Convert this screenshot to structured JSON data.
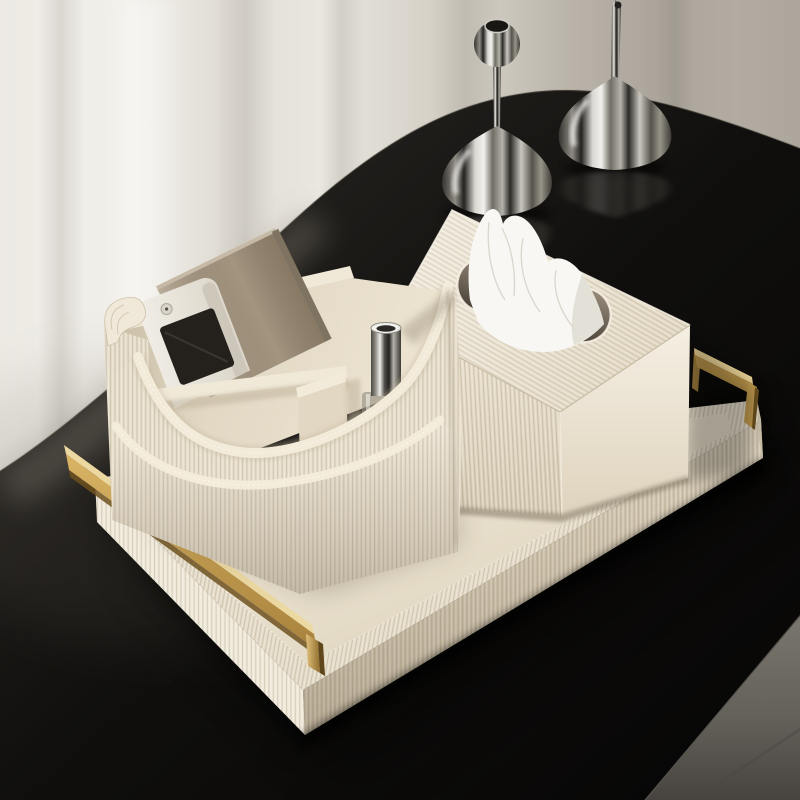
{
  "image": {
    "type": "product-photograph",
    "subject": "Ivory pleated-leather desk organizer set on a round black table",
    "setting": "Soft daylight room with sheer curtain backdrop, grey floor at lower right"
  },
  "objects": [
    {
      "name": "serving-tray",
      "description": "rectangular pleated ivory leather tray with brushed brass square handles"
    },
    {
      "name": "tray-handle-left",
      "description": "brushed brass rectangular handle, near end"
    },
    {
      "name": "tray-handle-right",
      "description": "brushed brass rectangular handle, far end"
    },
    {
      "name": "tissue-box",
      "description": "pleated ivory leather tissue box cover with white tissue pulled through rounded slot"
    },
    {
      "name": "organizer-caddy",
      "description": "pleated ivory leather storage caddy with scooped front pocket and dividers"
    },
    {
      "name": "remote-control",
      "description": "white remote control with dark display standing in caddy"
    },
    {
      "name": "paper-card",
      "description": "taupe card leaning behind the remote"
    },
    {
      "name": "atomizer-bottle",
      "description": "glass perfume atomizer with tall chrome cap in right compartment"
    },
    {
      "name": "vase-left",
      "description": "polished chrome teardrop vase with spherical top"
    },
    {
      "name": "vase-right",
      "description": "polished chrome teardrop vase with tall thin neck"
    },
    {
      "name": "table",
      "description": "round black lacquered tabletop"
    },
    {
      "name": "curtain",
      "description": "ivory-to-grey sheer curtain background"
    },
    {
      "name": "floor",
      "description": "grey floor visible past the table edge"
    }
  ],
  "palette": {
    "curtain_light": "#efede6",
    "curtain_dark": "#aba59b",
    "table_black": "#0b0a09",
    "floor_grey": "#716d66",
    "leather_cream": "#e7decb",
    "leather_light": "#f0e9d8",
    "leather_shadow": "#d0c5ae",
    "tray_floor": "#e9e1d0",
    "tissue_white": "#f8f7f3",
    "brass": "#c7a257",
    "brass_light": "#ecd9a2",
    "brass_dark": "#8f6d2c",
    "chrome_dark": "#2e2c29",
    "chrome_light": "#f0efeb",
    "card_taupe": "#a4957f",
    "remote_white": "#eeebe4",
    "screen_black": "#24211d"
  }
}
